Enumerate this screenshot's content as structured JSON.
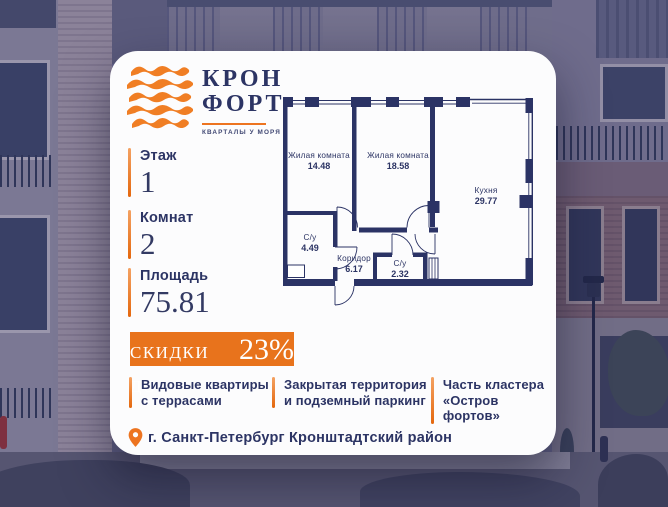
{
  "brand": {
    "name_line1": "КРОН",
    "name_line2": "ФОРТ",
    "tagline": "КВАРТАЛЫ У МОРЯ"
  },
  "stats": {
    "floor": {
      "label": "Этаж",
      "value": "1"
    },
    "rooms": {
      "label": "Комнат",
      "value": "2"
    },
    "area": {
      "label": "Площадь",
      "value": "75.81"
    }
  },
  "floorplan": {
    "rooms": [
      {
        "name": "Жилая комната",
        "area": "14.48"
      },
      {
        "name": "Жилая комната",
        "area": "18.58"
      },
      {
        "name": "Кухня",
        "area": "29.77"
      },
      {
        "name": "С/у",
        "area": "4.49"
      },
      {
        "name": "Коридор",
        "area": "6.17"
      },
      {
        "name": "С/у",
        "area": "2.32"
      }
    ]
  },
  "badge": {
    "prefix": "СКИДКИ ДО",
    "value": "23%"
  },
  "features": [
    {
      "line1": "Видовые квартиры",
      "line2": "с террасами"
    },
    {
      "line1": "Закрытая территория",
      "line2": "и подземный паркинг"
    },
    {
      "line1": "Часть кластера",
      "line2": "«Остров фортов»"
    }
  ],
  "location": {
    "text": "г. Санкт-Петербург Кронштадтский район"
  },
  "colors": {
    "accent_orange": "#ED7420",
    "badge_orange": "#E8731C",
    "navy_text": "#2C3464",
    "plan_walls": "#2B3365",
    "card_background": "#FCFCFD"
  }
}
